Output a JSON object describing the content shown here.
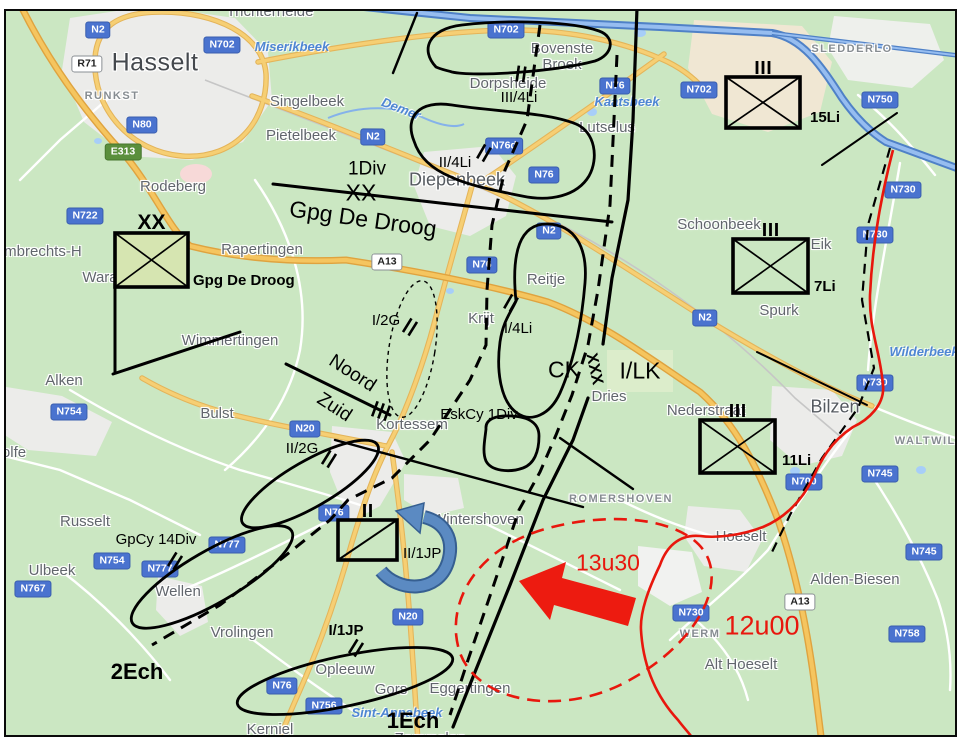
{
  "meta": {
    "description": "Tactical situation overlay on road map of the Hasselt - Diepenbeek - Bilzen area"
  },
  "colors": {
    "land": "#cbe7c2",
    "urban": "#ececea",
    "industrial": "#f0e7d3",
    "water": "#4f81c7",
    "road_major": "#f6cf74",
    "road_casing": "#dfa33f",
    "badge_blue": "#4a73cf",
    "badge_green": "#5a8f3c",
    "overlay_black": "#000000",
    "enemy_red": "#e8170d",
    "arrow_blue": "#4f81bd",
    "unit_fill_green": "#d6e5b1"
  },
  "map": {
    "towns": [
      {
        "label": "Hasselt",
        "x": 155,
        "y": 63,
        "cls": "town-xl"
      },
      {
        "label": "Trichterheide",
        "x": 270,
        "y": 12,
        "cls": "town-lg"
      },
      {
        "label": "RUNKST",
        "x": 112,
        "y": 97,
        "cls": "town-sm"
      },
      {
        "label": "Singelbeek",
        "x": 307,
        "y": 102,
        "cls": "town-lg"
      },
      {
        "label": "Pietelbeek",
        "x": 301,
        "y": 136,
        "cls": "town-lg"
      },
      {
        "label": "Rodeberg",
        "x": 173,
        "y": 187,
        "cls": "town-lg"
      },
      {
        "label": "Bovenste\nBroek",
        "x": 562,
        "y": 57,
        "cls": "town-lg"
      },
      {
        "label": "Dorpsheide",
        "x": 508,
        "y": 84,
        "cls": "town-lg"
      },
      {
        "label": "Lutselus",
        "x": 607,
        "y": 128,
        "cls": "town-lg"
      },
      {
        "label": "SLEDDERLO",
        "x": 852,
        "y": 50,
        "cls": "town-sm"
      },
      {
        "label": "Diepenbeek",
        "x": 457,
        "y": 180,
        "cls": "town-big"
      },
      {
        "label": "Rapertingen",
        "x": 262,
        "y": 250,
        "cls": "town-lg"
      },
      {
        "label": "t-Lambrechts-H",
        "x": 30,
        "y": 252,
        "cls": "town-lg"
      },
      {
        "label": "Wara",
        "x": 100,
        "y": 278,
        "cls": "town-lg"
      },
      {
        "label": "Wimmertingen",
        "x": 230,
        "y": 341,
        "cls": "town-lg"
      },
      {
        "label": "Alken",
        "x": 64,
        "y": 381,
        "cls": "town-lg"
      },
      {
        "label": "Bulst",
        "x": 217,
        "y": 414,
        "cls": "town-lg"
      },
      {
        "label": "Russelt",
        "x": 85,
        "y": 522,
        "cls": "town-lg"
      },
      {
        "label": "Ulbeek",
        "x": 52,
        "y": 571,
        "cls": "town-lg"
      },
      {
        "label": "Wellen",
        "x": 178,
        "y": 592,
        "cls": "town-lg"
      },
      {
        "label": "olfe",
        "x": 14,
        "y": 453,
        "cls": "town-lg"
      },
      {
        "label": "Vrolingen",
        "x": 242,
        "y": 633,
        "cls": "town-lg"
      },
      {
        "label": "Opleeuw",
        "x": 345,
        "y": 670,
        "cls": "town-lg"
      },
      {
        "label": "Gors",
        "x": 391,
        "y": 690,
        "cls": "town-lg"
      },
      {
        "label": "Eggertingen",
        "x": 470,
        "y": 689,
        "cls": "town-lg"
      },
      {
        "label": "Kerniel",
        "x": 270,
        "y": 730,
        "cls": "town-lg"
      },
      {
        "label": "Zammelen",
        "x": 430,
        "y": 739,
        "cls": "town-lg"
      },
      {
        "label": "Kortessem",
        "x": 412,
        "y": 425,
        "cls": "town-lg"
      },
      {
        "label": "Wintershoven",
        "x": 478,
        "y": 520,
        "cls": "town-lg"
      },
      {
        "label": "ROMERSHOVEN",
        "x": 621,
        "y": 500,
        "cls": "town-sm"
      },
      {
        "label": "Schoonbeek",
        "x": 719,
        "y": 225,
        "cls": "town-lg"
      },
      {
        "label": "Eik",
        "x": 821,
        "y": 245,
        "cls": "town-lg"
      },
      {
        "label": "Spurk",
        "x": 779,
        "y": 311,
        "cls": "town-lg"
      },
      {
        "label": "Reitje",
        "x": 546,
        "y": 280,
        "cls": "town-lg"
      },
      {
        "label": "Krijt",
        "x": 481,
        "y": 319,
        "cls": "town-lg"
      },
      {
        "label": "Dries",
        "x": 609,
        "y": 397,
        "cls": "town-lg"
      },
      {
        "label": "Bilzen",
        "x": 835,
        "y": 407,
        "cls": "town-big"
      },
      {
        "label": "Nederstraat",
        "x": 706,
        "y": 411,
        "cls": "town-lg"
      },
      {
        "label": "WALTWILD",
        "x": 930,
        "y": 442,
        "cls": "town-sm"
      },
      {
        "label": "Hoeselt",
        "x": 741,
        "y": 537,
        "cls": "town-lg"
      },
      {
        "label": "Alden-Biesen",
        "x": 855,
        "y": 580,
        "cls": "town-lg"
      },
      {
        "label": "Alt Hoeselt",
        "x": 741,
        "y": 665,
        "cls": "town-lg"
      },
      {
        "label": "WERM",
        "x": 700,
        "y": 635,
        "cls": "town-sm"
      }
    ],
    "water_labels": [
      {
        "label": "Miserikbeek",
        "x": 292,
        "y": 47
      },
      {
        "label": "Kaatsbeek",
        "x": 627,
        "y": 102
      },
      {
        "label": "Demer",
        "x": 401,
        "y": 109,
        "rot": 21
      },
      {
        "label": "Wilderbeek",
        "x": 924,
        "y": 352
      },
      {
        "label": "Sint-Annabeek",
        "x": 397,
        "y": 713
      }
    ],
    "road_badges": [
      {
        "label": "N2",
        "x": 98,
        "y": 30,
        "type": "blue"
      },
      {
        "label": "N702",
        "x": 222,
        "y": 45,
        "type": "blue"
      },
      {
        "label": "R71",
        "x": 87,
        "y": 64,
        "type": "white"
      },
      {
        "label": "N80",
        "x": 142,
        "y": 125,
        "type": "blue"
      },
      {
        "label": "E313",
        "x": 123,
        "y": 152,
        "type": "green"
      },
      {
        "label": "N722",
        "x": 85,
        "y": 216,
        "type": "blue"
      },
      {
        "label": "N2",
        "x": 373,
        "y": 137,
        "type": "blue"
      },
      {
        "label": "N702",
        "x": 506,
        "y": 30,
        "type": "blue"
      },
      {
        "label": "N76",
        "x": 615,
        "y": 86,
        "type": "blue"
      },
      {
        "label": "N76d",
        "x": 504,
        "y": 146,
        "type": "blue"
      },
      {
        "label": "N76",
        "x": 544,
        "y": 175,
        "type": "blue"
      },
      {
        "label": "N702",
        "x": 699,
        "y": 90,
        "type": "blue"
      },
      {
        "label": "N750",
        "x": 880,
        "y": 100,
        "type": "blue"
      },
      {
        "label": "N730",
        "x": 903,
        "y": 190,
        "type": "blue"
      },
      {
        "label": "N730",
        "x": 875,
        "y": 235,
        "type": "blue"
      },
      {
        "label": "N2",
        "x": 549,
        "y": 231,
        "type": "blue"
      },
      {
        "label": "A13",
        "x": 387,
        "y": 262,
        "type": "white"
      },
      {
        "label": "N76",
        "x": 482,
        "y": 265,
        "type": "blue"
      },
      {
        "label": "N2",
        "x": 705,
        "y": 318,
        "type": "blue"
      },
      {
        "label": "N730",
        "x": 875,
        "y": 383,
        "type": "blue"
      },
      {
        "label": "N754",
        "x": 69,
        "y": 412,
        "type": "blue"
      },
      {
        "label": "N20",
        "x": 305,
        "y": 429,
        "type": "blue"
      },
      {
        "label": "N777",
        "x": 227,
        "y": 545,
        "type": "blue"
      },
      {
        "label": "N754",
        "x": 112,
        "y": 561,
        "type": "blue"
      },
      {
        "label": "N777",
        "x": 160,
        "y": 569,
        "type": "blue"
      },
      {
        "label": "N767",
        "x": 33,
        "y": 589,
        "type": "blue"
      },
      {
        "label": "N76",
        "x": 334,
        "y": 513,
        "type": "blue"
      },
      {
        "label": "N20",
        "x": 408,
        "y": 617,
        "type": "blue"
      },
      {
        "label": "N76",
        "x": 282,
        "y": 686,
        "type": "blue"
      },
      {
        "label": "N756",
        "x": 324,
        "y": 706,
        "type": "blue"
      },
      {
        "label": "N745",
        "x": 880,
        "y": 474,
        "type": "blue"
      },
      {
        "label": "N700",
        "x": 804,
        "y": 482,
        "type": "blue"
      },
      {
        "label": "N745",
        "x": 924,
        "y": 552,
        "type": "blue"
      },
      {
        "label": "N730",
        "x": 691,
        "y": 613,
        "type": "blue"
      },
      {
        "label": "A13",
        "x": 800,
        "y": 602,
        "type": "white"
      },
      {
        "label": "N758",
        "x": 907,
        "y": 634,
        "type": "blue"
      }
    ],
    "military_labels": [
      {
        "label": "1Div",
        "x": 367,
        "y": 170,
        "cls": "ml-lg"
      },
      {
        "label": "XX",
        "x": 361,
        "y": 193,
        "cls": "ml-xl"
      },
      {
        "label": "Gpg De Droog",
        "x": 363,
        "y": 219,
        "cls": "ml-xl",
        "rot": 8
      },
      {
        "label": "III/4Li",
        "x": 519,
        "y": 98,
        "cls": "ml"
      },
      {
        "label": "II/4Li",
        "x": 455,
        "y": 163,
        "cls": "ml"
      },
      {
        "label": "I/4Li",
        "x": 518,
        "y": 329,
        "cls": "ml"
      },
      {
        "label": "I/2G",
        "x": 386,
        "y": 321,
        "cls": "ml"
      },
      {
        "label": "II/2G",
        "x": 302,
        "y": 449,
        "cls": "ml"
      },
      {
        "label": "Noord",
        "x": 352,
        "y": 374,
        "cls": "ml-lg",
        "rot": 33
      },
      {
        "label": "Zuid",
        "x": 334,
        "y": 408,
        "cls": "ml-lg",
        "rot": 33
      },
      {
        "label": "EskCy 1Div",
        "x": 479,
        "y": 415,
        "cls": "ml"
      },
      {
        "label": "CK",
        "x": 564,
        "y": 370,
        "cls": "ml-xl"
      },
      {
        "label": "XXX",
        "x": 594,
        "y": 369,
        "cls": "ml-xxx",
        "rot": 78
      },
      {
        "label": "I/LK",
        "x": 640,
        "y": 371,
        "cls": "ml-xl"
      },
      {
        "label": "GpCy 14Div",
        "x": 156,
        "y": 540,
        "cls": "ml"
      },
      {
        "label": "I/1JP",
        "x": 346,
        "y": 631,
        "cls": "ml-bold"
      },
      {
        "label": "2Ech",
        "x": 137,
        "y": 672,
        "cls": "ml-xl-bold"
      },
      {
        "label": "1Ech",
        "x": 413,
        "y": 721,
        "cls": "ml-xl-bold"
      },
      {
        "label": "13u30",
        "x": 608,
        "y": 563,
        "cls": "ml-red"
      },
      {
        "label": "12u00",
        "x": 762,
        "y": 626,
        "cls": "ml-red-lg"
      }
    ],
    "unit_symbols": [
      {
        "designation": "Gpg De Droog",
        "echelon": "XX",
        "branch": "infantry",
        "x": 115,
        "y": 233,
        "w": 73,
        "h": 54,
        "fill": "#d6e5b1",
        "label_x": 193,
        "label_y": 281,
        "label_cls": "ml-bold",
        "label_anchor": "left"
      },
      {
        "designation": "15Li",
        "echelon": "III",
        "branch": "infantry",
        "x": 726,
        "y": 77,
        "w": 74,
        "h": 51,
        "fill": "none",
        "label_x": 810,
        "label_y": 118,
        "label_cls": "ml-bold",
        "label_anchor": "left"
      },
      {
        "designation": "7Li",
        "echelon": "III",
        "branch": "infantry",
        "x": 733,
        "y": 239,
        "w": 75,
        "h": 54,
        "fill": "none",
        "label_x": 814,
        "label_y": 287,
        "label_cls": "ml-bold",
        "label_anchor": "left"
      },
      {
        "designation": "11Li",
        "echelon": "III",
        "branch": "infantry",
        "x": 700,
        "y": 420,
        "w": 75,
        "h": 53,
        "fill": "none",
        "label_x": 782,
        "label_y": 461,
        "label_cls": "ml-bold",
        "label_anchor": "left"
      },
      {
        "designation": "II/1JP",
        "echelon": "II",
        "branch": "cavalry",
        "x": 338,
        "y": 520,
        "w": 59,
        "h": 40,
        "fill": "none",
        "label_x": 403,
        "label_y": 554,
        "label_cls": "ml",
        "label_anchor": "left"
      }
    ],
    "tick_marks": [
      {
        "x": 521,
        "y": 74,
        "rot": 8,
        "n": 2
      },
      {
        "x": 484,
        "y": 153,
        "rot": 30,
        "n": 2
      },
      {
        "x": 511,
        "y": 303,
        "rot": 30,
        "n": 2
      },
      {
        "x": 410,
        "y": 327,
        "rot": 32,
        "n": 2
      },
      {
        "x": 381,
        "y": 411,
        "rot": 20,
        "n": 3
      },
      {
        "x": 329,
        "y": 459,
        "rot": 32,
        "n": 2
      },
      {
        "x": 175,
        "y": 561,
        "rot": 32,
        "n": 2
      },
      {
        "x": 356,
        "y": 648,
        "rot": 32,
        "n": 2
      }
    ]
  }
}
